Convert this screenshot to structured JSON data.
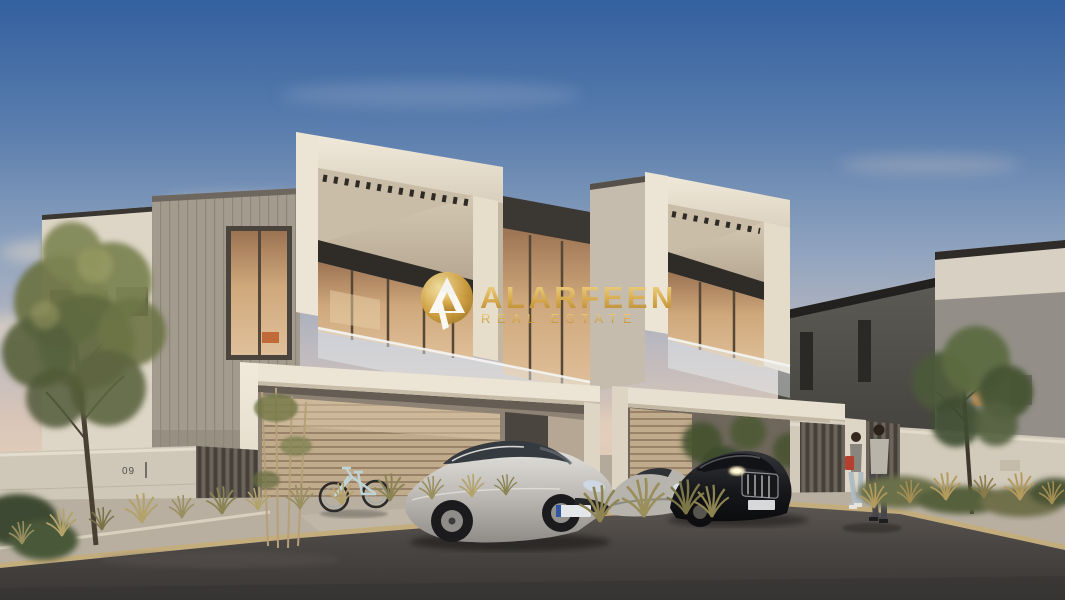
{
  "image": {
    "kind": "real-estate-listing-render",
    "description": "Dusk 3D architectural rendering of modern two-storey duplex townhouses with carports, a silver sedan, a black sedan, a bicycle, two pedestrians, landscaping and a street in front",
    "time_of_day": "dusk"
  },
  "watermark": {
    "brand": "ALARFEEN",
    "tagline": "REAL ESTATE",
    "logo_icon": "alarfeen-a-monogram-gold-circle",
    "colors": {
      "gold_light": "#f4dc92",
      "gold": "#d2a243",
      "gold_dark": "#96701f",
      "mark_white": "#fdfcf8"
    }
  },
  "scene": {
    "house_number": "09",
    "elements": [
      "dusk-sky",
      "clouds",
      "duplex-villa",
      "pergola-slats",
      "balcony-glass",
      "warm-lit-windows",
      "carport-left",
      "carport-right",
      "garage-door",
      "bicycle",
      "silver-sedan",
      "black-sedan",
      "silver-coupe",
      "pedestrians",
      "boundary-wall",
      "slat-fence",
      "planting-grasses",
      "trees",
      "sidewalk",
      "curb",
      "asphalt-road",
      "neighbour-villa-right",
      "neighbour-wing-left"
    ]
  },
  "palette": {
    "sky_top": "#33609f",
    "sky_mid": "#8fa3bf",
    "sky_horizon": "#e6cfba",
    "facade_white": "#ece4d4",
    "facade_shadow": "#bfb19c",
    "trim_dark": "#332e29",
    "window_warm": "#c89d72",
    "glass_cool": "#dfe8ec",
    "wood_door": "#bfa98c",
    "road": "#3b3937",
    "curb": "#c4ad7d",
    "foliage_green": "#6d7446",
    "grass_gold": "#b3a26a"
  }
}
